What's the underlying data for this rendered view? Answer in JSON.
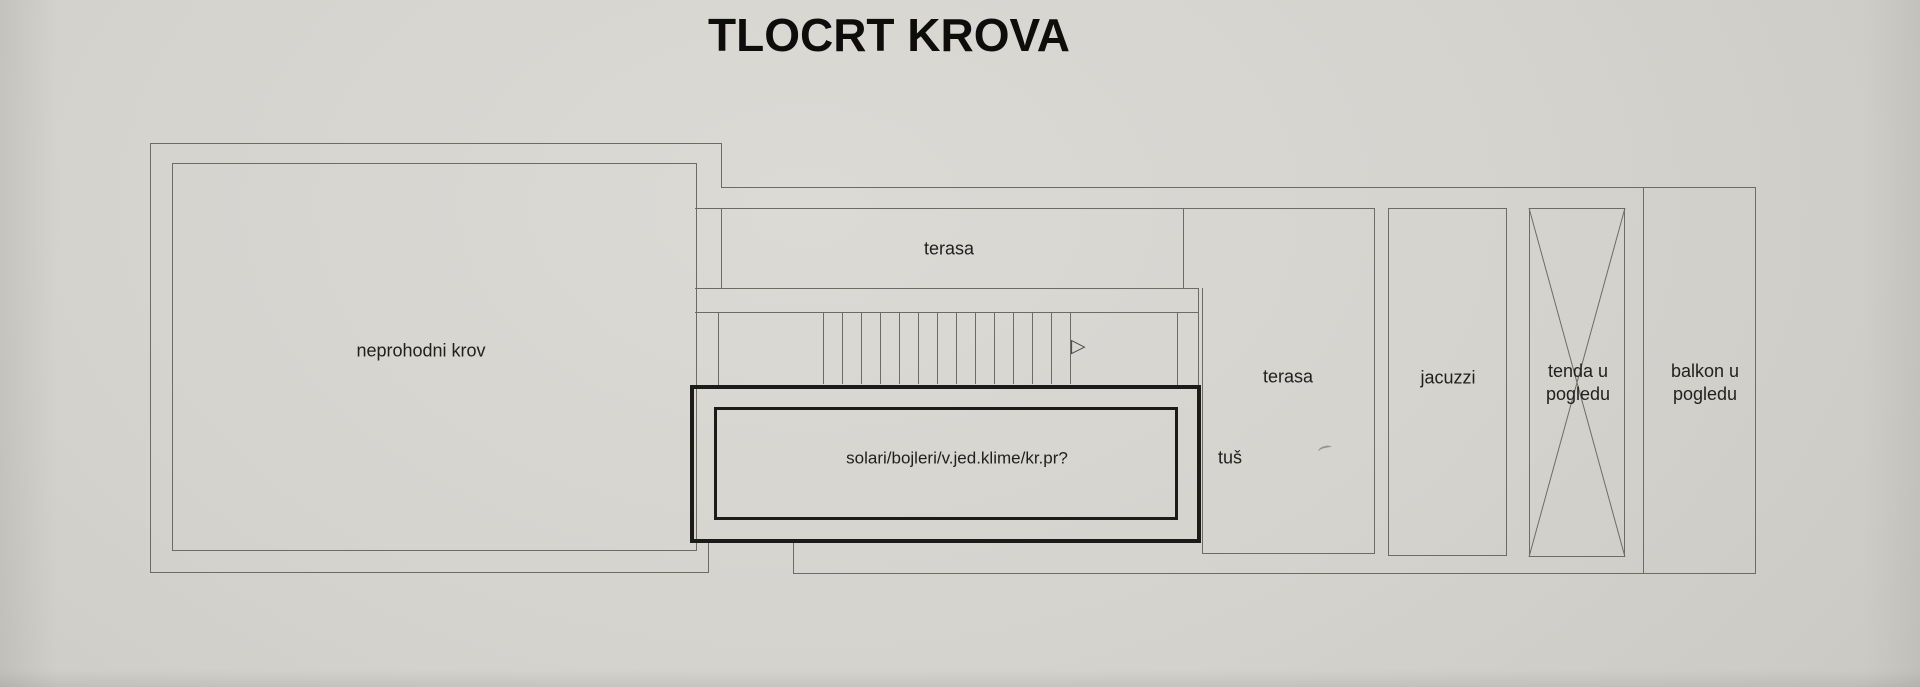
{
  "title": "TLOCRT KROVA",
  "colors": {
    "paper_bg": "#d5d3ce",
    "paper_bg_light": "#dcdad5",
    "paper_bg_dark": "#cac8c3",
    "thin_line": "#6c6c66",
    "thick_line": "#1b1b19",
    "text_ink": "#1f1f1d"
  },
  "floor_plan": {
    "rooms": {
      "neprohodni_krov": "neprohodni krov",
      "terasa_upper": "terasa",
      "terasa_right": "terasa",
      "tus": "tuš",
      "solari_box": "solari/bojleri/v.jed.klime/kr.pr?",
      "jacuzzi": "jacuzzi",
      "tenda_line1": "tenda u",
      "tenda_line2": "pogledu",
      "balkon_line1": "balkon u",
      "balkon_line2": "pogledu"
    },
    "stairs": {
      "step_count": 14,
      "direction_icon": "▷"
    }
  }
}
